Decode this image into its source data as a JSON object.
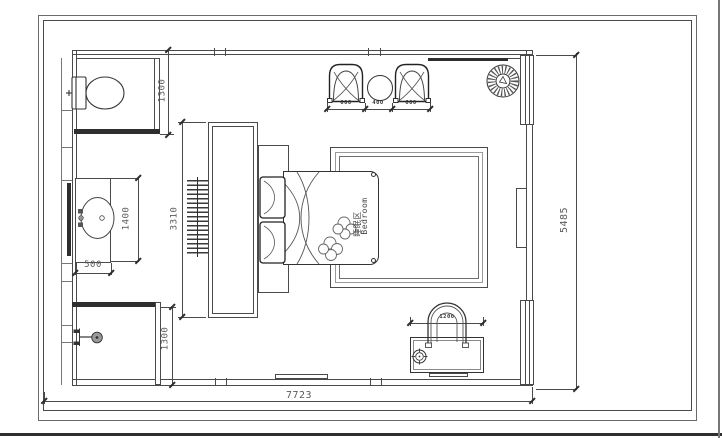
{
  "drawing": {
    "room_label": {
      "zh": "睡眠区",
      "en": "Bedroom"
    },
    "dims": {
      "toilet_room_depth": "1300",
      "vanity_length": "1400",
      "vanity_width": "500",
      "tv_wall_length": "3310",
      "shower_room_depth": "1300",
      "armchair_left_width": "600",
      "side_table_width": "400",
      "armchair_right_width": "600",
      "desk_chair_width": "1200",
      "overall_width": "7723",
      "overall_depth": "5485"
    },
    "colors": {
      "line": "#4a4a4a",
      "wall_dark": "#2e2e2e",
      "text": "#5a5a5a",
      "background": "#ffffff"
    },
    "icons": [
      "toilet-icon",
      "sink-icon",
      "shower-head-icon",
      "ceiling-fan-icon",
      "armchair-icon",
      "side-table-icon",
      "double-bed-icon",
      "pillow-icon",
      "desk-icon",
      "desk-chair-icon",
      "survey-point-icon"
    ]
  }
}
